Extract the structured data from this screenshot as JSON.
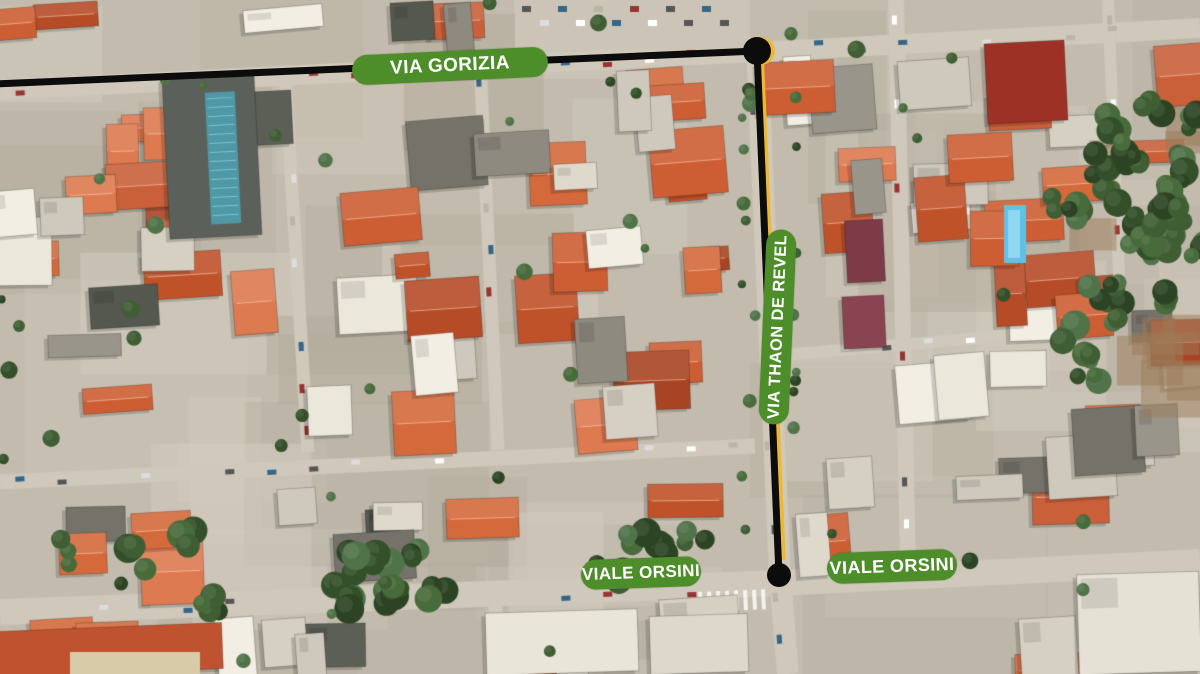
{
  "map": {
    "description": "Annotated aerial satellite view of city blocks with highlighted route",
    "label_style": {
      "background": "#4d8e2a",
      "text": "#ffffff"
    },
    "street_labels": [
      {
        "id": "via-gorizia",
        "text": "VIA GORIZIA",
        "cx": 450,
        "cy": 66,
        "w": 196,
        "h": 30,
        "rot": -2.7,
        "font": 19
      },
      {
        "id": "via-thaon-de-revel",
        "text": "VIA THAON DE REVEL",
        "cx": 777,
        "cy": 327,
        "w": 195,
        "h": 30,
        "rot": -87.5,
        "font": 16.5
      },
      {
        "id": "viale-orsini-west",
        "text": "VIALE ORSINI",
        "cx": 641,
        "cy": 573,
        "w": 120,
        "h": 30,
        "rot": -2,
        "font": 17
      },
      {
        "id": "viale-orsini-east",
        "text": "VIALE ORSINI",
        "cx": 892,
        "cy": 566,
        "w": 130,
        "h": 31,
        "rot": -2,
        "font": 18
      }
    ],
    "route": {
      "line_color": "#0c0c0c",
      "highlight_color": "#efb92f",
      "segments": [
        {
          "name": "route-segment-via-gorizia",
          "x1": -5,
          "y1": 84,
          "x2": 757,
          "y2": 51,
          "width": 7,
          "highlighted": false
        },
        {
          "name": "route-segment-via-thaon-de-revel",
          "x1": 757,
          "y1": 51,
          "x2": 779,
          "y2": 575,
          "width": 7,
          "highlighted": true
        }
      ],
      "highlight_line": {
        "x1": 762,
        "y1": 54,
        "x2": 784,
        "y2": 560,
        "width": 3.5
      },
      "nodes": [
        {
          "name": "route-node-gorizia-thaon",
          "x": 757,
          "y": 51,
          "r": 14
        },
        {
          "name": "route-node-thaon-orsini",
          "x": 779,
          "y": 575,
          "r": 12
        }
      ]
    }
  }
}
